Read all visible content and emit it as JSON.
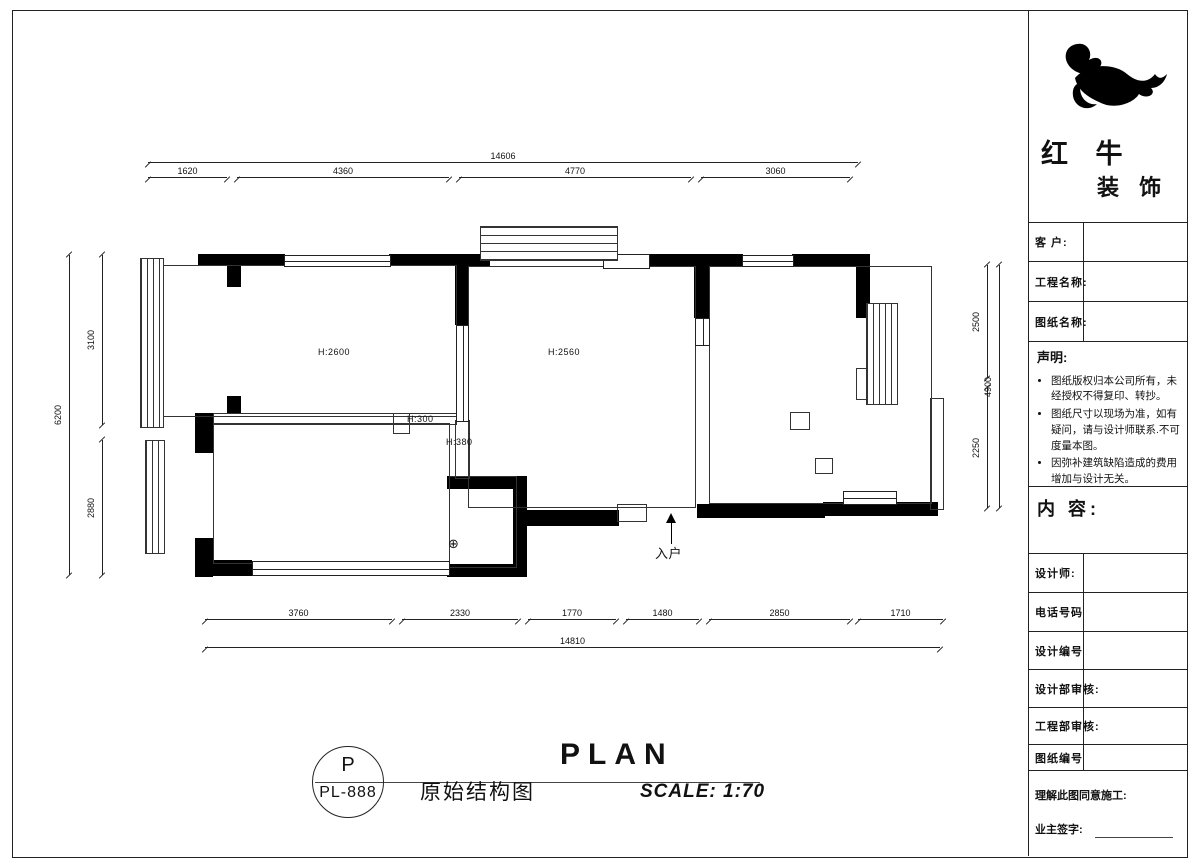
{
  "plan": {
    "room_labels": {
      "room_left": "H:2600",
      "room_middle": "H:2560",
      "ledge": "H:300",
      "niche": "H:380"
    },
    "entrance_label": "入户",
    "drain_symbol": "⊕",
    "dimensions": {
      "top": {
        "total": "14606",
        "segments": [
          "1620",
          "4360",
          "4770",
          "3060"
        ]
      },
      "bottom": {
        "total": "14810",
        "segments": [
          "3760",
          "2330",
          "1770",
          "1480",
          "2850",
          "1710"
        ]
      },
      "left": {
        "total": "6200",
        "segments": [
          "3100",
          "2880"
        ]
      },
      "right": {
        "total": "4900",
        "segments": [
          "2500",
          "2250"
        ]
      }
    }
  },
  "footer": {
    "tag_top": "P",
    "tag_bottom": "PL-888",
    "drawing_title_cn": "原始结构图",
    "drawing_title_en": "PLAN",
    "scale": "SCALE: 1:70"
  },
  "title_block": {
    "brand_line1": "红 牛",
    "brand_line2": "装 饰",
    "fields_top": [
      "客 户:",
      "工程名称:",
      "图纸名称:"
    ],
    "statement": {
      "heading": "声明:",
      "items": [
        "图纸版权归本公司所有，未经授权不得复印、转抄。",
        "图纸尺寸以现场为准，如有疑问，请与设计师联系.不可度量本图。",
        "因弥补建筑缺陷造成的费用增加与设计无关。"
      ]
    },
    "content_heading": "内 容:",
    "fields_bottom": [
      "设计师:",
      "电话号码",
      "设计编号",
      "设计部审核:",
      "工程部审核:",
      "图纸编号"
    ],
    "signature_line1": "理解此图同意施工:",
    "signature_line2": "业主签字:"
  },
  "colors": {
    "ink": "#111111",
    "wall": "#000000",
    "paper": "#ffffff"
  }
}
